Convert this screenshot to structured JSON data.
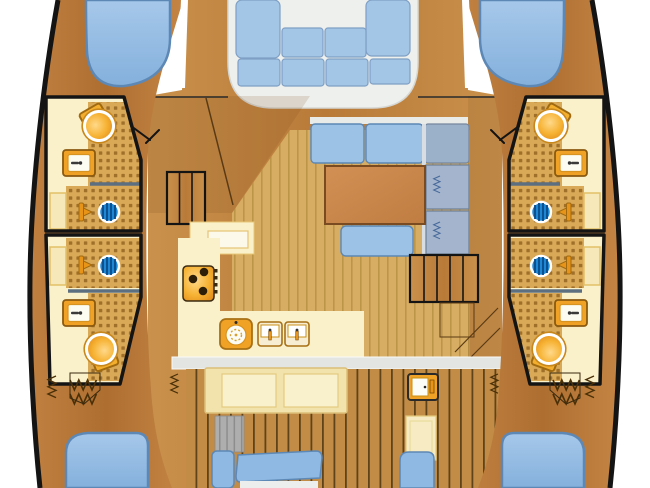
{
  "diagram": {
    "label": "Catamaran yacht interior deck plan, top-down view",
    "regions": {
      "port_hull": [
        "forward-berth",
        "forward-head",
        "aft-head",
        "wardrobe-lockers",
        "aft-berth"
      ],
      "starboard_hull": [
        "forward-berth",
        "forward-head",
        "aft-head",
        "wardrobe-lockers",
        "aft-berth"
      ],
      "bridgedeck": [
        "forward-cockpit",
        "salon",
        "galley",
        "aft-cockpit"
      ]
    },
    "head_fixtures": [
      "toilet",
      "washbasin",
      "shower-drain",
      "shower-mixer",
      "locker-door"
    ],
    "galley": {
      "stove_burners": 3,
      "round_sink_bowls": 1,
      "double_sink_bowls": 2
    },
    "salon": {
      "furniture": [
        "dining-table",
        "sofa-cushions",
        "chart-cabinet",
        "port-stairs",
        "starboard-stairs"
      ]
    },
    "forward_cockpit": {
      "cushion_count": 8,
      "bench_shape": "U"
    },
    "aft_cockpit": {
      "furniture": [
        "cockpit-table",
        "fridge",
        "port-bench",
        "starboard-bench",
        "helm-steps"
      ]
    }
  },
  "colors": {
    "hull_wood": "#c0803c",
    "deck_teak": "#c28c46",
    "salon_floor": "#d6ad62",
    "head_floor": "#faf0ca",
    "shower_tile": "#d9a958",
    "fixture_orange": "#f0a226",
    "cushion_blue": "#a3c6e6",
    "bed_blue": "#8fb9e2",
    "drain_blue": "#1e88d4",
    "cabinet_gray": "#a3b4cc",
    "outline_black": "#141414",
    "bench_white": "#eef0ed"
  }
}
